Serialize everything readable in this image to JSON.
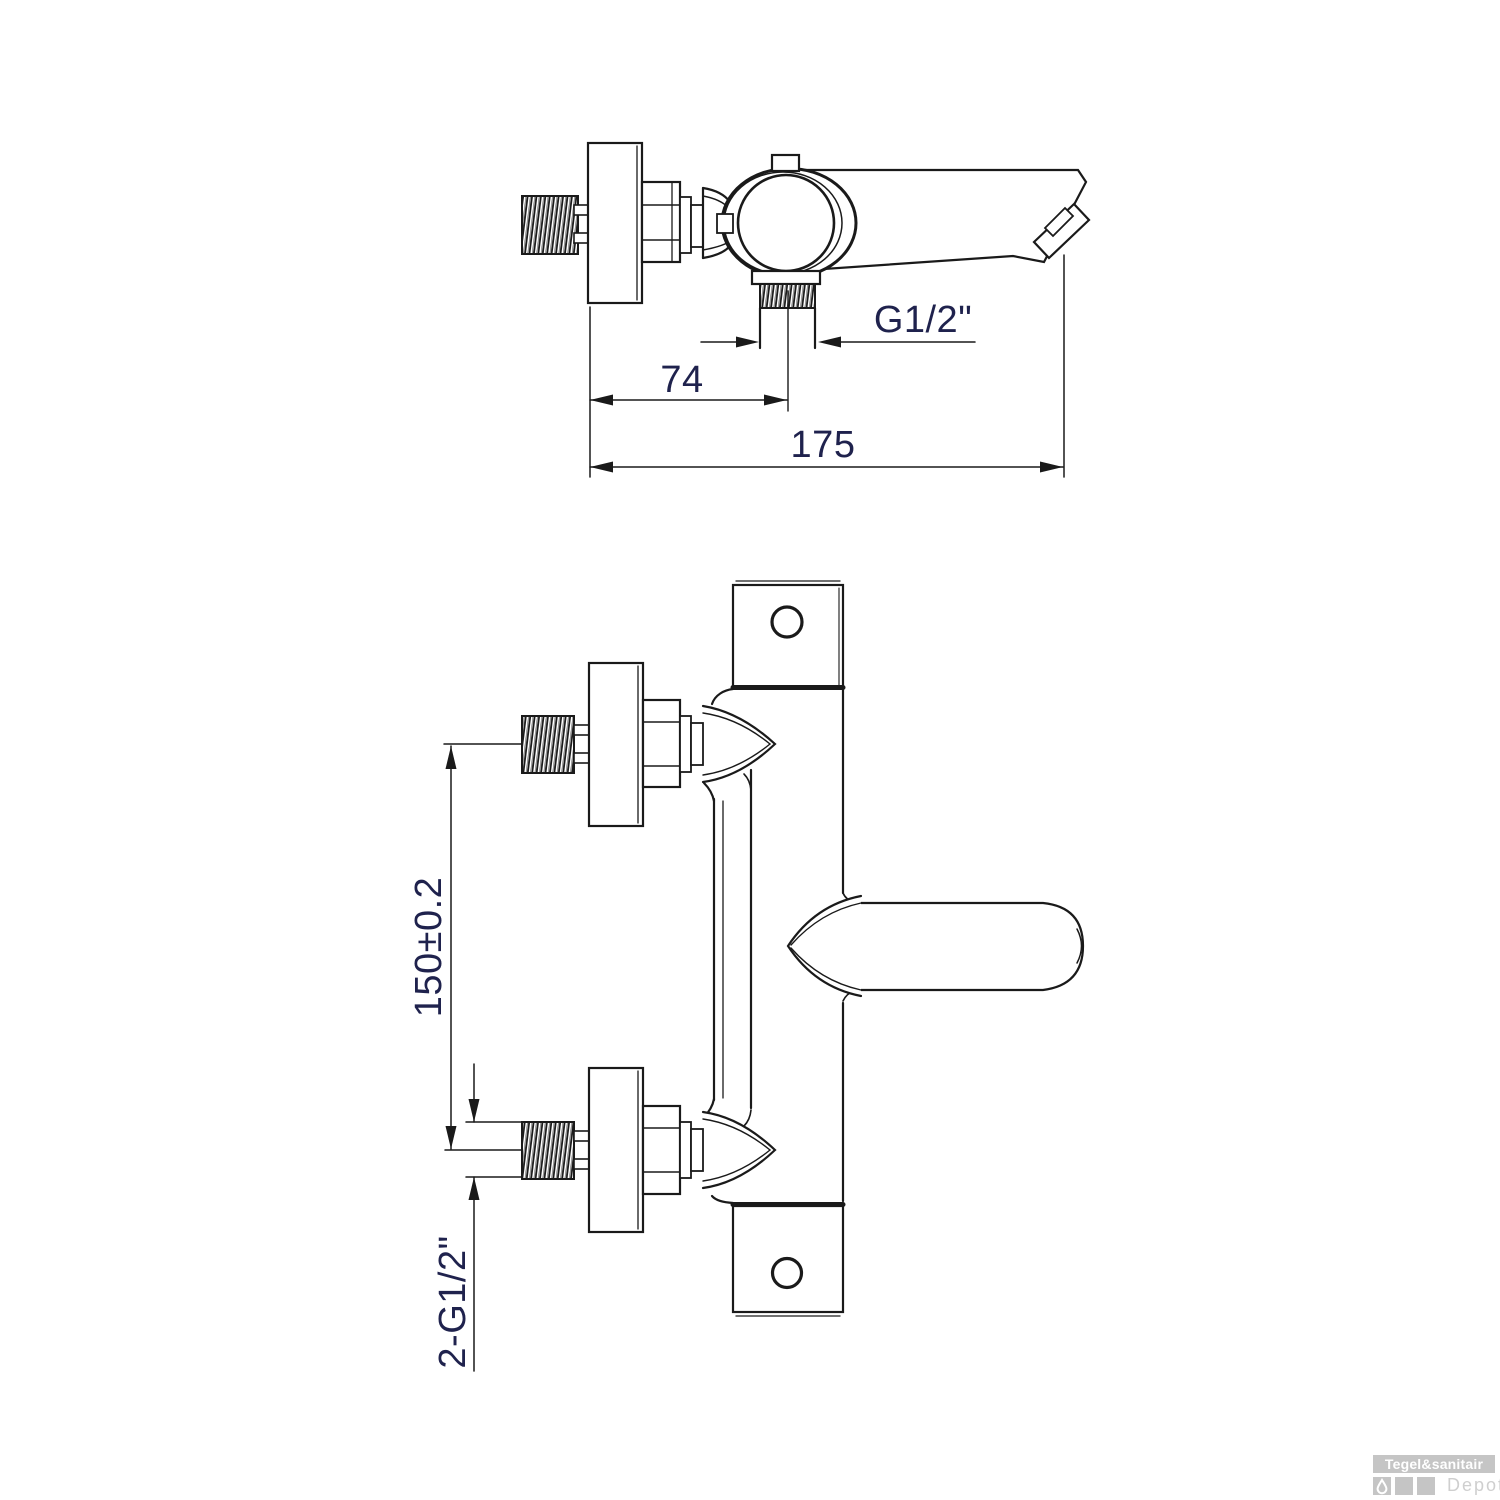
{
  "dimensions": {
    "outlet_thread_label": "G1/2\"",
    "wall_to_outlet_mm": "74",
    "total_length_mm": "175",
    "inlet_spacing_mm": "150±0.2",
    "inlet_thread_label": "2-G1/2\""
  },
  "watermark": {
    "brand": "Tegel&sanitair",
    "suffix": "Depot"
  },
  "colors": {
    "line": "#1a1a1a",
    "dimension_text": "#1f224d",
    "watermark_gray": "#c5c5c5",
    "watermark_text_light": "#cfcfcf",
    "background": "#ffffff"
  }
}
